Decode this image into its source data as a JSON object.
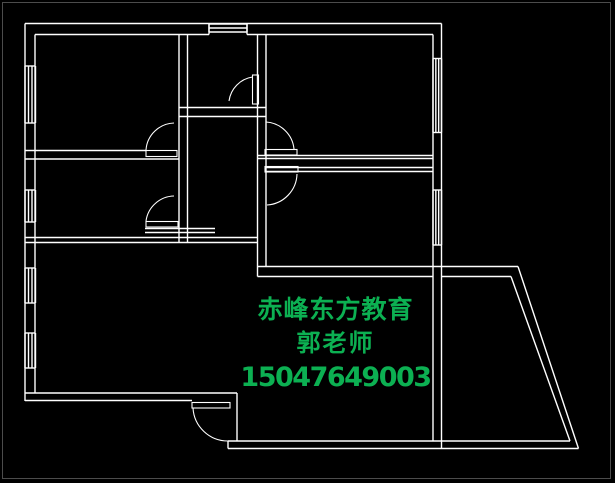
{
  "canvas": {
    "width": 615,
    "height": 483,
    "background": "#000000",
    "frame_color": "#4c4c4c",
    "wall_color": "#ffffff"
  },
  "watermark": {
    "line1": "赤峰东方教育",
    "line2": "郭老师",
    "line3": "15047649003",
    "color": "#0cb052"
  },
  "floorplan": {
    "walls": [
      [
        25,
        23.5,
        441.5,
        23.5
      ],
      [
        35,
        34.5,
        209,
        34.5
      ],
      [
        247,
        34.5,
        433,
        34.5
      ],
      [
        25,
        23.5,
        25,
        401
      ],
      [
        35,
        34.5,
        35,
        393
      ],
      [
        441.5,
        23.5,
        441.5,
        448.5
      ],
      [
        433,
        34.5,
        433,
        441
      ],
      [
        25,
        393,
        237,
        393
      ],
      [
        25,
        400.5,
        192,
        400.5
      ],
      [
        237,
        393,
        237,
        441
      ],
      [
        228,
        441,
        570,
        441
      ],
      [
        228,
        448.5,
        578.5,
        448.5
      ],
      [
        228,
        441,
        228,
        448.5
      ],
      [
        179,
        34.5,
        179,
        242.5
      ],
      [
        187.5,
        34.5,
        187.5,
        242.5
      ],
      [
        257.5,
        34.5,
        257.5,
        276.5
      ],
      [
        266,
        34.5,
        266,
        266.5
      ],
      [
        179,
        107.5,
        266,
        107.5
      ],
      [
        179,
        116.5,
        266,
        116.5
      ],
      [
        25,
        150.5,
        146,
        150.5
      ],
      [
        25,
        159,
        179,
        159
      ],
      [
        257.5,
        155.5,
        433,
        155.5
      ],
      [
        257.5,
        158.5,
        433,
        158.5
      ],
      [
        266,
        167.5,
        433,
        167.5
      ],
      [
        266,
        171.5,
        433,
        171.5
      ],
      [
        25,
        237.5,
        257.5,
        237.5
      ],
      [
        25,
        242.5,
        257.5,
        242.5
      ],
      [
        145,
        228.5,
        215,
        228.5
      ],
      [
        145,
        232.5,
        215,
        232.5
      ],
      [
        257.5,
        266.5,
        518,
        266.5
      ],
      [
        257.5,
        276.5,
        433,
        276.5
      ],
      [
        441.5,
        276.5,
        511,
        276.5
      ],
      [
        518,
        266.5,
        578.5,
        448.5
      ],
      [
        511,
        276.5,
        570,
        441
      ],
      [
        209,
        23.5,
        209,
        34.5
      ],
      [
        247,
        23.5,
        247,
        34.5
      ]
    ],
    "windows": [
      {
        "x": 25,
        "y": 66,
        "w": 10.5,
        "h": 57,
        "dir": "v",
        "n": 4
      },
      {
        "x": 25,
        "y": 190,
        "w": 10.5,
        "h": 32,
        "dir": "v",
        "n": 4
      },
      {
        "x": 25,
        "y": 268,
        "w": 10.5,
        "h": 35,
        "dir": "v",
        "n": 4
      },
      {
        "x": 25,
        "y": 333,
        "w": 10.5,
        "h": 35,
        "dir": "v",
        "n": 4
      },
      {
        "x": 209,
        "y": 24,
        "w": 38,
        "h": 8,
        "dir": "h",
        "n": 3
      },
      {
        "x": 433,
        "y": 58.5,
        "w": 8.5,
        "h": 74,
        "dir": "v",
        "n": 4
      },
      {
        "x": 433,
        "y": 190,
        "w": 8.5,
        "h": 55,
        "dir": "v",
        "n": 4
      }
    ],
    "door_leaves": [
      [
        252.5,
        75,
        6,
        29
      ],
      [
        146,
        150.5,
        31,
        6
      ],
      [
        146,
        221.5,
        32,
        5.5
      ],
      [
        265,
        149.5,
        32,
        5.5
      ],
      [
        265,
        166.5,
        33,
        5.5
      ],
      [
        192,
        402.5,
        38,
        5.5
      ]
    ],
    "door_arcs": [
      "M252.5 77 A28 28 0 0 0 229 101",
      "M146 150 A29 29 0 0 1 174 123",
      "M146 221 A29 29 0 0 1 174 196",
      "M266 122 A30 30 0 0 1 294 149",
      "M297 174 A32 32 0 0 1 267 205",
      "M193 408 A35 35 0 0 0 228 441"
    ]
  }
}
